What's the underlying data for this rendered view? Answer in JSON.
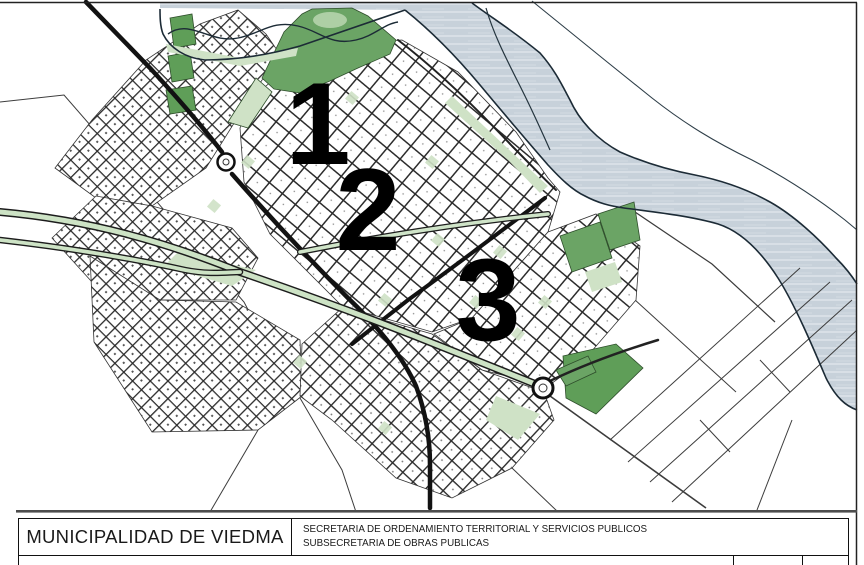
{
  "title_block": {
    "municipality": "MUNICIPALIDAD DE VIEDMA",
    "secretary_line1": "SECRETARIA DE ORDENAMIENTO TERRITORIAL Y SERVICIOS PUBLICOS",
    "secretary_line2": "SUBSECRETARIA DE OBRAS PUBLICAS"
  },
  "map": {
    "zone_labels": [
      {
        "name": "zone-1",
        "text": "1"
      },
      {
        "name": "zone-2",
        "text": "2"
      },
      {
        "name": "zone-3",
        "text": "3"
      }
    ],
    "colors": {
      "river_fill": "#c7d1da",
      "river_outline": "#1c2b36",
      "park_green": "#6ba465",
      "light_green": "#cfe2c6",
      "road_color": "#141414",
      "frame_gray": "#4d4d4d",
      "paper": "#ffffff"
    }
  }
}
